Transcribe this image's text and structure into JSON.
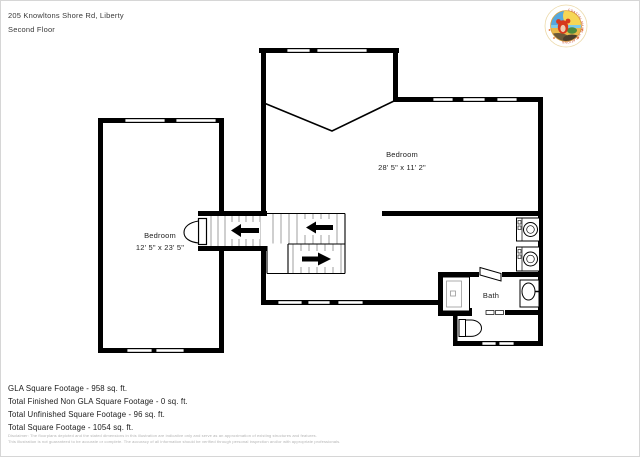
{
  "header": {
    "address": "205 Knowltons Shore Rd, Liberty",
    "floor": "Second Floor"
  },
  "logo": {
    "arc_text": "COASTAL MAINE VACATIONS"
  },
  "floorplan": {
    "rooms": [
      {
        "name": "Bedroom",
        "dimensions": "12' 5\" x 23' 5\""
      },
      {
        "name": "Bedroom",
        "dimensions": "28' 5\" x 11' 2\""
      },
      {
        "name": "Bath"
      }
    ]
  },
  "footer": {
    "stats": [
      "GLA Square Footage - 958 sq. ft.",
      "Total Finished Non GLA Square Footage - 0 sq. ft.",
      "Total Unfinished Square Footage - 96 sq. ft.",
      "Total Square Footage - 1054 sq. ft."
    ],
    "disclaimer": [
      "Disclaimer: The floorplans depicted and the stated dimensions in this illustration are indicative only and serve as an approximation of existing structures and features.",
      "This illustration is not guaranteed to be accurate or complete. The accuracy of all information should be verified through personal inspection and/or with appropriate professionals."
    ]
  },
  "colors": {
    "wall": "#000000",
    "tread": "#777777",
    "disclaimer_text": "#b4b4b4",
    "logo_ring_text": "#c8401f",
    "logo_sky": "#56a8de",
    "logo_sand": "#e9b94b"
  }
}
